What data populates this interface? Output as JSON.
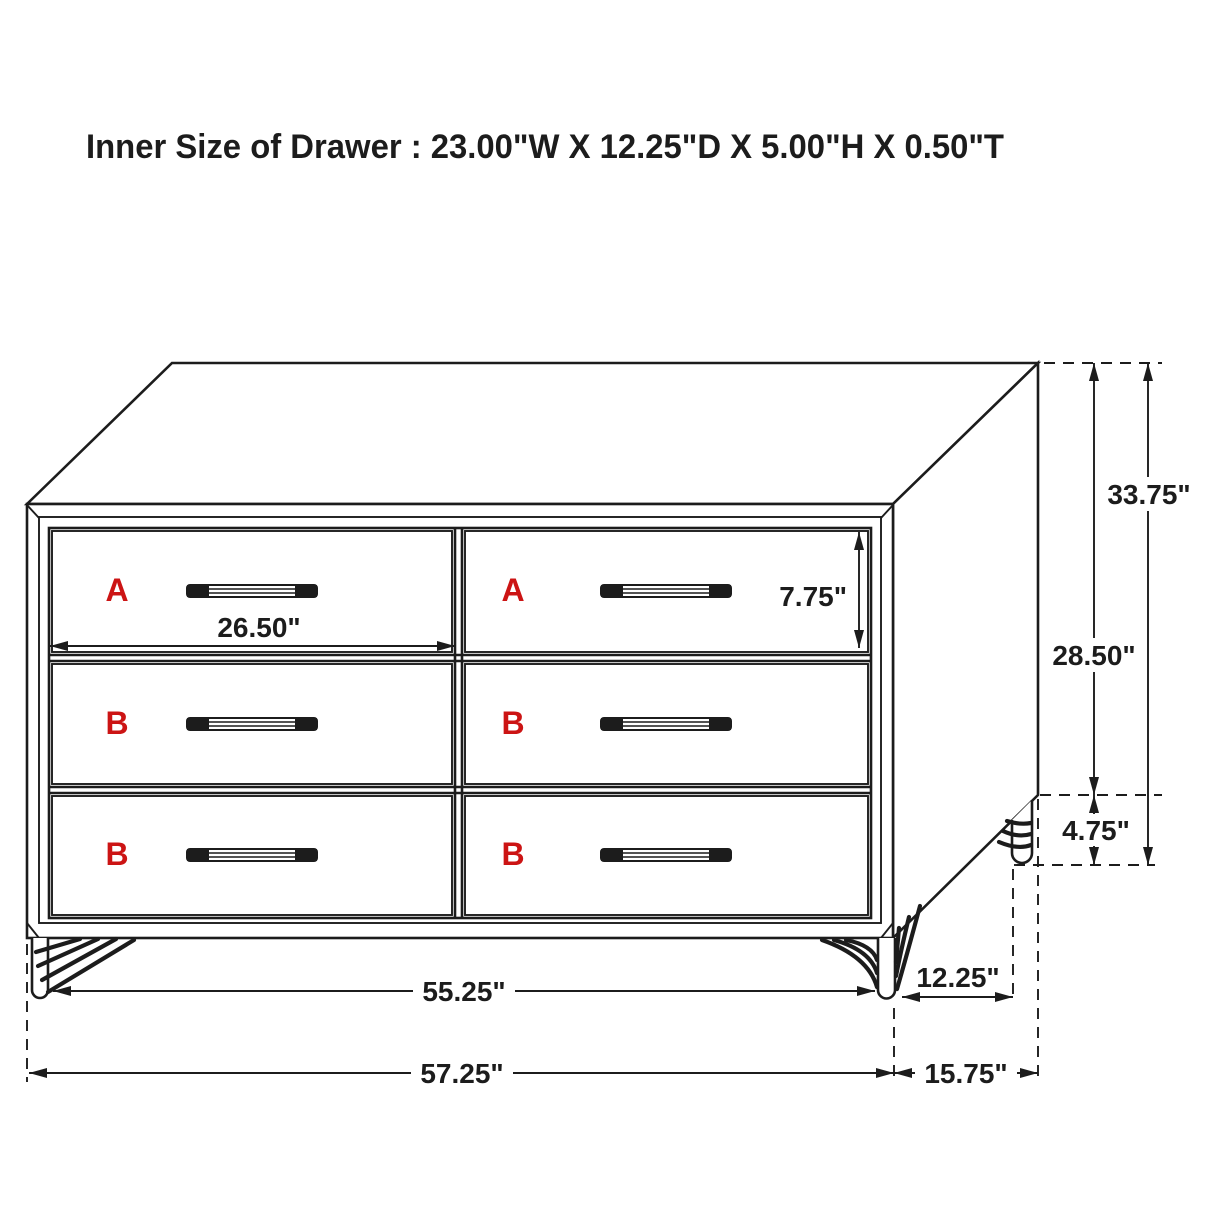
{
  "title": "Inner Size of Drawer : 23.00\"W X 12.25\"D X 5.00\"H X 0.50\"T",
  "drawer_labels": [
    "A",
    "A",
    "B",
    "B",
    "B",
    "B"
  ],
  "dimensions": {
    "drawer_opening_width": "26.50\"",
    "top_drawer_height": "7.75\"",
    "overall_height": "33.75\"",
    "case_height": "28.50\"",
    "leg_height": "4.75\"",
    "base_width": "55.25\"",
    "leg_depth_span": "12.25\"",
    "overall_width": "57.25\"",
    "overall_depth": "15.75\""
  },
  "colors": {
    "line": "#1c1c1c",
    "label_red": "#cc1414",
    "background": "#ffffff"
  }
}
